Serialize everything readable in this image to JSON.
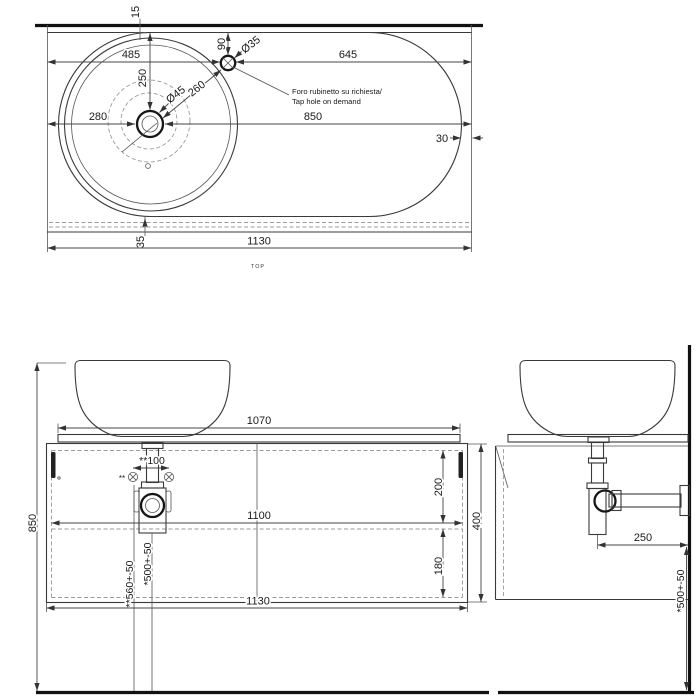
{
  "drawing_type": "washbasin technical drawing",
  "colors": {
    "line": "#3a3a3a",
    "heavy_line": "#111111",
    "dashed": "#9a9a9a",
    "text": "#1a1a1a",
    "background": "#ffffff"
  },
  "top": {
    "label": "TOP",
    "note1": "Foro rubinetto su richiesta/",
    "note2": "Tap hole on demand",
    "wall_gap": "15",
    "left_to_tap": "485",
    "tap_to_right": "645",
    "tap_setback": "90",
    "tap_diameter": "Ø35",
    "back_to_drain": "250",
    "drain_diameter": "Ø45",
    "drain_to_tap": "260",
    "left_to_drain": "280",
    "drain_to_right": "850",
    "side_inset": "30",
    "front_inset": "35",
    "total_width": "1130"
  },
  "front": {
    "rim_height": "850",
    "counter_width": "1070",
    "screw_marker": "**",
    "screw_spacing": "**100",
    "inner_width": "1100",
    "upper_inner_height": "200",
    "lower_inner_height": "180",
    "frame_height": "400",
    "screw_height": "**560+-50",
    "drain_height": "*500+-50",
    "total_width": "1130"
  },
  "side": {
    "drain_to_wall": "250",
    "outlet_height": "*500+-50"
  }
}
